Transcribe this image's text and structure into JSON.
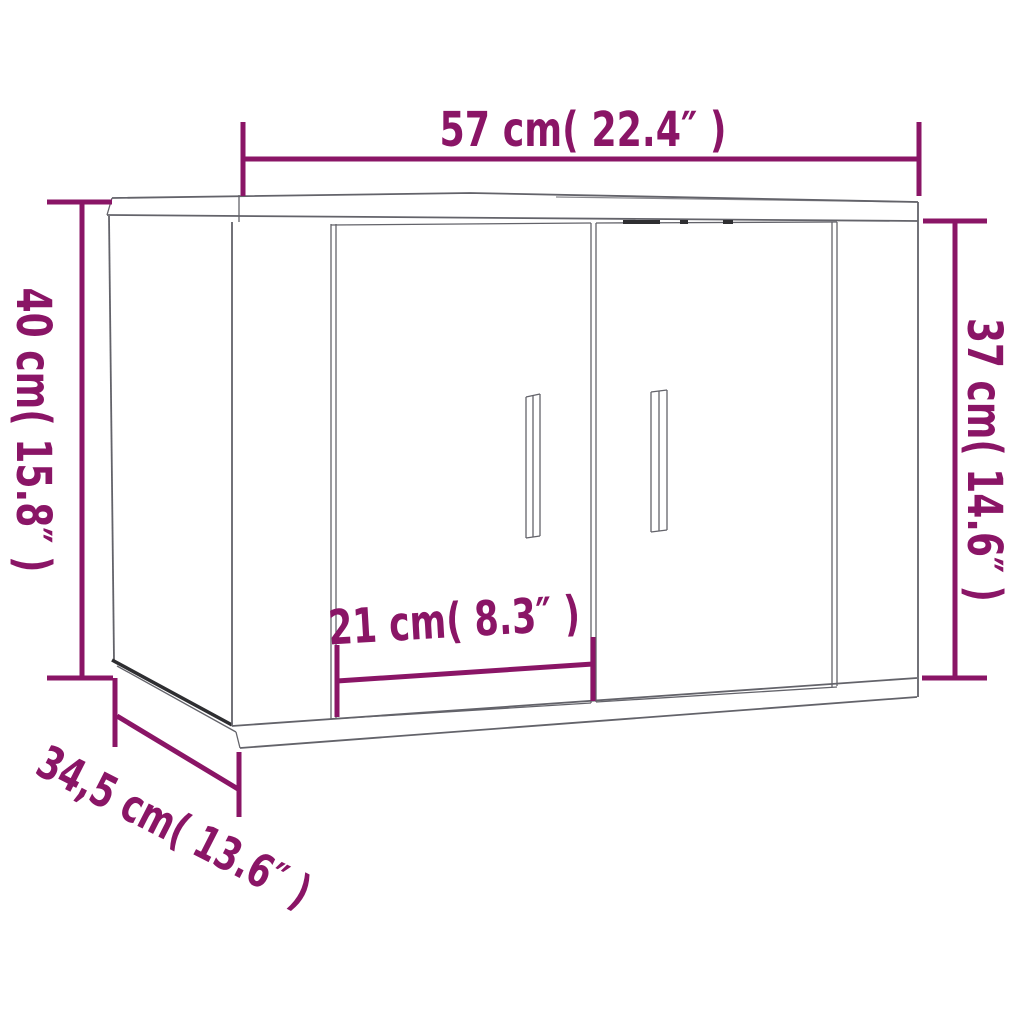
{
  "colors": {
    "background": "#ffffff",
    "dimension": "#8A1566",
    "line": "#63636a",
    "line_dark": "#2e2e31"
  },
  "dimensions": {
    "width": {
      "label": "57 cm( 22.4″ )"
    },
    "height_left": {
      "label": "40 cm( 15.8″ )"
    },
    "height_right": {
      "label": "37 cm( 14.6″ )"
    },
    "door_width": {
      "label": "21 cm( 8.3″ )"
    },
    "depth": {
      "label": "34,5 cm( 13.6″ )"
    }
  }
}
